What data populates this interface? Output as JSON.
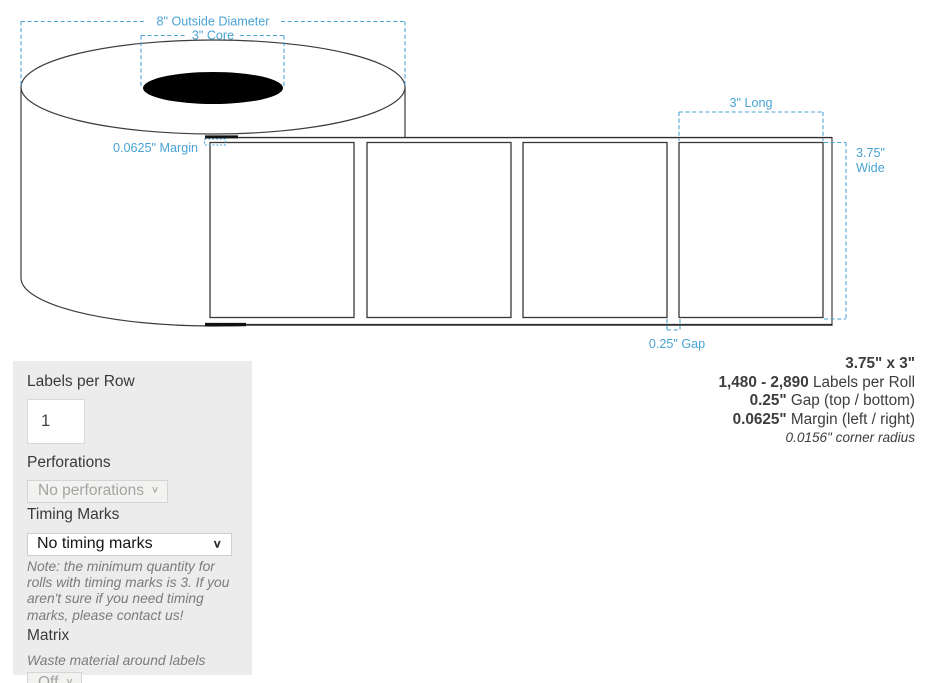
{
  "diagram": {
    "annotations": {
      "outside_diameter": "8\" Outside Diameter",
      "core": "3\" Core",
      "margin": "0.0625\" Margin",
      "long": "3\" Long",
      "wide_line1": "3.75\"",
      "wide_line2": "Wide",
      "gap": "0.25\" Gap"
    },
    "colors": {
      "annotation_blue": "#4aa3d4",
      "outline": "#3c3c3c",
      "core_fill": "#000000"
    },
    "label_count": 4
  },
  "form": {
    "labels_per_row_label": "Labels per Row",
    "labels_per_row_value": "1",
    "perforations_label": "Perforations",
    "perforations_value": "No perforations",
    "timing_marks_label": "Timing Marks",
    "timing_marks_value": "No timing marks",
    "timing_note": "Note: the minimum quantity for rolls with timing marks is 3. If you aren't sure if you need timing marks, please contact us!",
    "matrix_label": "Matrix",
    "matrix_description": "Waste material around labels",
    "matrix_value": "Off"
  },
  "specs": {
    "size": "3.75\" x 3\"",
    "lines": [
      {
        "bold": "1,480 - 2,890",
        "rest": " Labels per Roll"
      },
      {
        "bold": "0.25\"",
        "rest": " Gap (top / bottom)"
      },
      {
        "bold": "0.0625\"",
        "rest": " Margin (left / right)"
      }
    ],
    "corner_radius": "0.0156\" corner radius"
  },
  "icons": {
    "chevron_down": "∨"
  }
}
